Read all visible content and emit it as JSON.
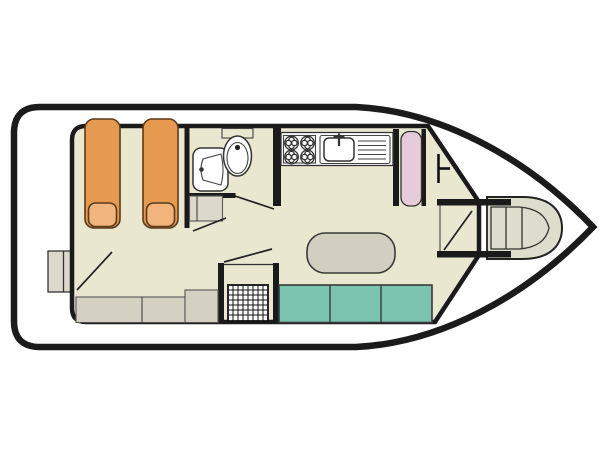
{
  "plan": {
    "type": "houseboat-floor-plan",
    "colors": {
      "background": "#ffffff",
      "white": "#ffffff",
      "floor": "#eae7d1",
      "bed_orange": "#e69a4f",
      "pillow_orange": "#f1b47c",
      "seat_teal": "#7cc3b0",
      "wardrobe_pink": "#e5ccd8",
      "table_grey": "#d2cfc0",
      "furniture_grey": "#d5d1c2",
      "steps_grey": "#dcd9cc",
      "deck_grey": "#dcddcc",
      "outline": "#1b1b1b"
    },
    "furniture": [
      "single-berth-left",
      "single-berth-right",
      "berth-pillows",
      "washbasin",
      "toilet",
      "four-burner-stove",
      "sink-with-drainer",
      "wardrobe",
      "dinette-table",
      "three-seat-bench",
      "shower-tray",
      "aft-bench",
      "interior-steps",
      "stern-boarding-steps",
      "bow-walkway-door",
      "bow-deck"
    ]
  }
}
